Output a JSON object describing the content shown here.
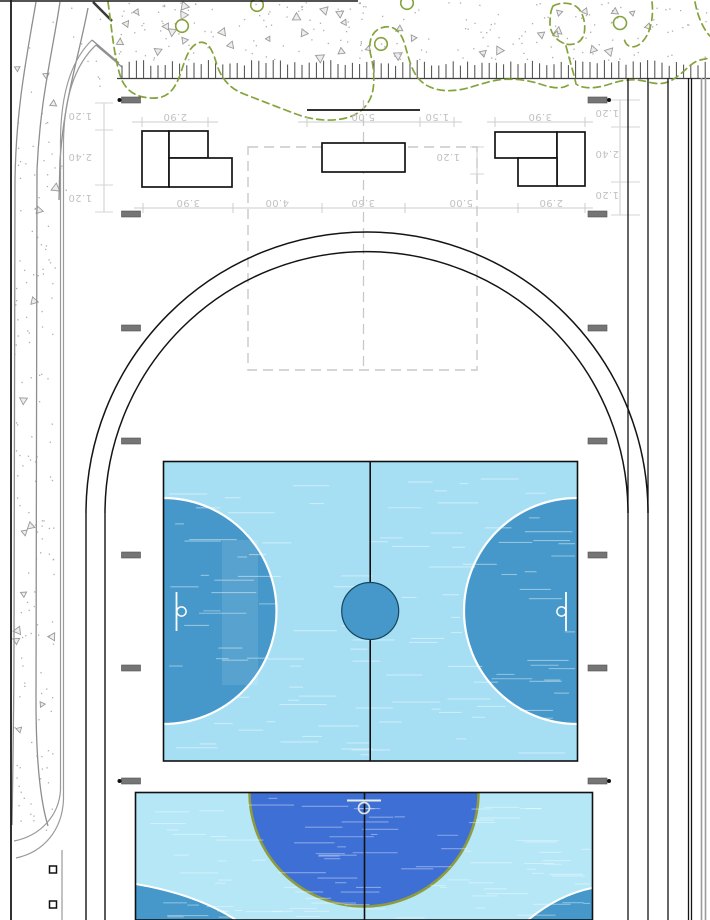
{
  "drawing": {
    "kind": "sports-field-site-plan",
    "dimensions": {
      "top_row": [
        "2.90",
        "5.00",
        "1.50",
        "3.90"
      ],
      "second_row": [
        "3.90",
        "4.00",
        "3.60",
        "5.00",
        "2.90"
      ],
      "left_column": [
        "1.20",
        "2.40",
        "1.20"
      ],
      "right_column": [
        "1.20",
        "2.40",
        "1.20"
      ],
      "gap": "1.20"
    },
    "colors": {
      "court_light": "#a6dff4",
      "court_light2": "#b5e7f7",
      "goal_blue": "#4598c9",
      "royal_blue": "#3e6fd5",
      "olive": "#8e9c3e",
      "vegetation_green": "#84a33b",
      "dim_gray": "#c2c2c2",
      "road_gray": "#8e8e8e",
      "track_line": "#2a2a2a"
    }
  }
}
